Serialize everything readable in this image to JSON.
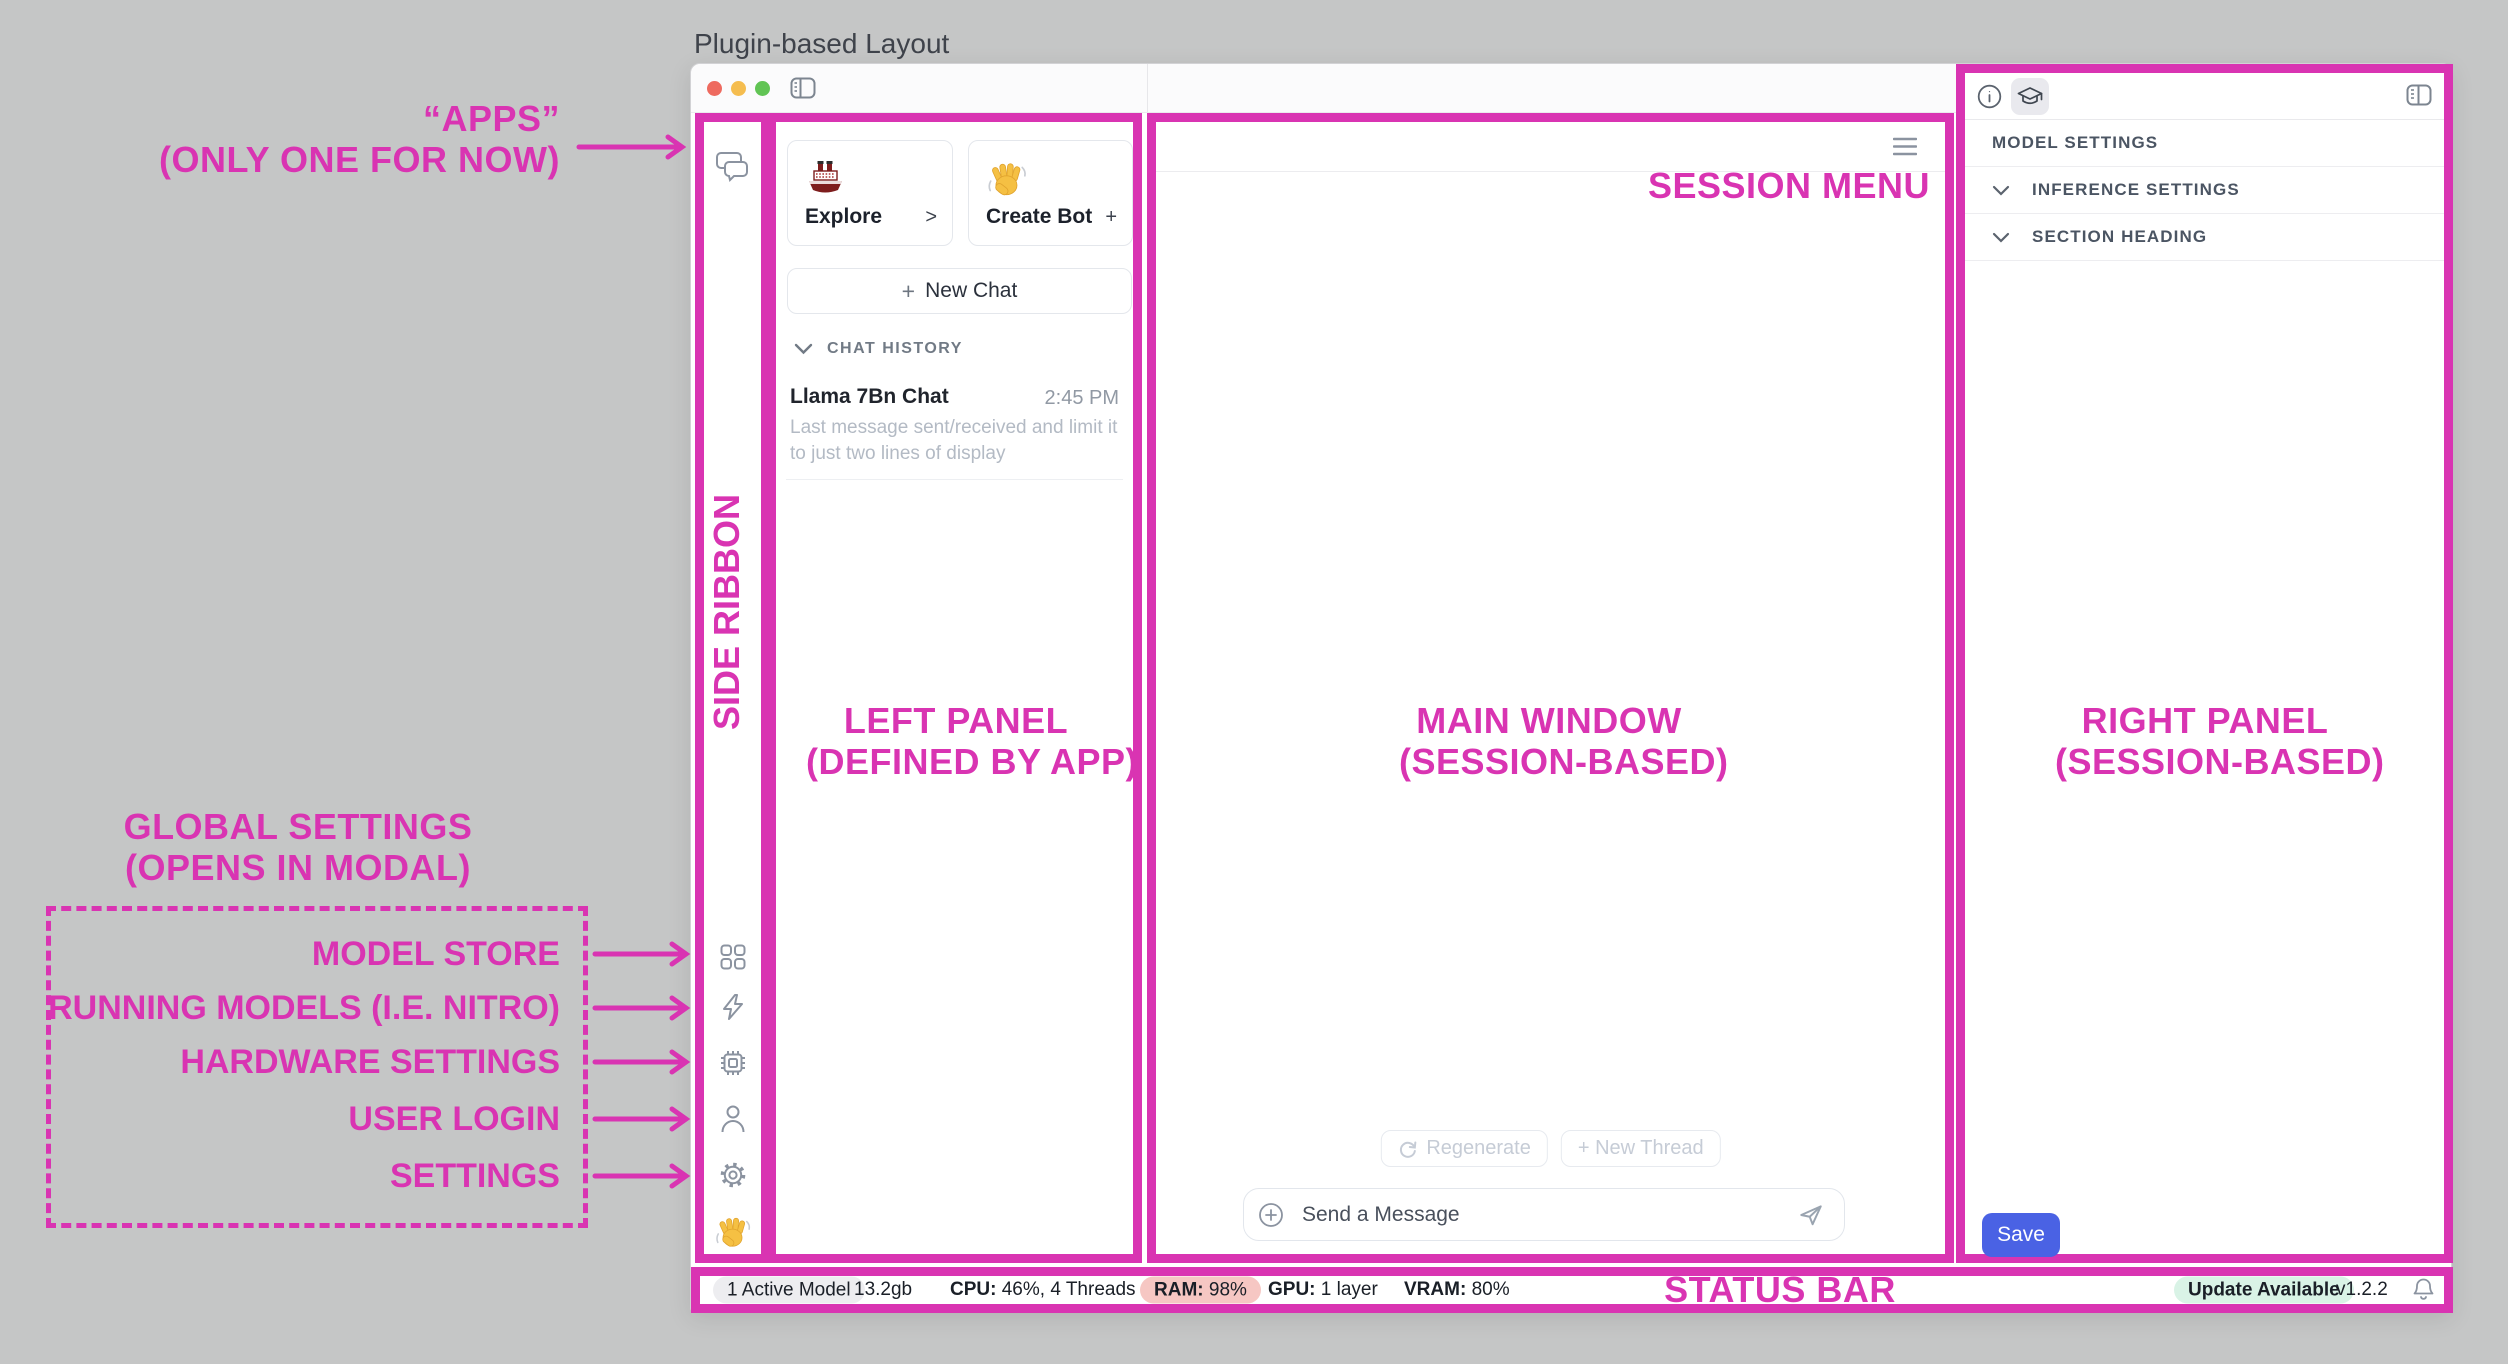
{
  "page": {
    "title": "Plugin-based Layout"
  },
  "colors": {
    "annotation_pink": "#d934b2",
    "save_blue": "#4a62e4",
    "ram_warn_pill": "#f6c7c3",
    "update_pill_green": "#d9f3e6"
  },
  "annotations": {
    "apps": {
      "line1": "“APPS”",
      "line2": "(ONLY ONE FOR NOW)"
    },
    "side_ribbon": "SIDE RIBBON",
    "left_panel": {
      "line1": "LEFT PANEL",
      "line2": "(DEFINED BY APP)"
    },
    "main_window": {
      "line1": "MAIN WINDOW",
      "line2": "(SESSION-BASED)"
    },
    "right_panel": {
      "line1": "RIGHT PANEL",
      "line2": "(SESSION-BASED)"
    },
    "session_menu": "SESSION MENU",
    "status_bar": "STATUS BAR",
    "global_settings": {
      "line1": "GLOBAL SETTINGS",
      "line2": "(OPENS IN MODAL)"
    },
    "ribbon_rows": [
      {
        "label": "MODEL STORE"
      },
      {
        "label": "RUNNING MODELS (I.E. NITRO)"
      },
      {
        "label": "HARDWARE SETTINGS"
      },
      {
        "label": "USER LOGIN"
      },
      {
        "label": "SETTINGS"
      }
    ]
  },
  "left_panel": {
    "cards": [
      {
        "emoji": "ship",
        "label": "Explore",
        "action": ">"
      },
      {
        "emoji": "wave",
        "label": "Create Bot",
        "action": "+"
      }
    ],
    "new_chat_plus": "+",
    "new_chat": "New Chat",
    "history_header": "CHAT HISTORY",
    "chat_item": {
      "title": "Llama 7Bn Chat",
      "time": "2:45 PM",
      "preview": "Last message sent/received and limit it to just two lines of display"
    }
  },
  "main_window": {
    "regenerate": "Regenerate",
    "new_thread": "+ New Thread",
    "composer_placeholder": "Send a Message"
  },
  "right_panel": {
    "sections": [
      {
        "label": "MODEL SETTINGS"
      },
      {
        "label": "INFERENCE SETTINGS"
      },
      {
        "label": "SECTION HEADING"
      }
    ],
    "save": "Save"
  },
  "status_bar": {
    "active_model": "1 Active Model",
    "memory": "13.2gb",
    "cpu_label": "CPU:",
    "cpu_value": "46%, 4 Threads",
    "ram_label": "RAM:",
    "ram_value": "98%",
    "gpu_label": "GPU:",
    "gpu_value": "1 layer",
    "vram_label": "VRAM:",
    "vram_value": "80%",
    "update": "Update Available",
    "version": "v1.2.2"
  }
}
